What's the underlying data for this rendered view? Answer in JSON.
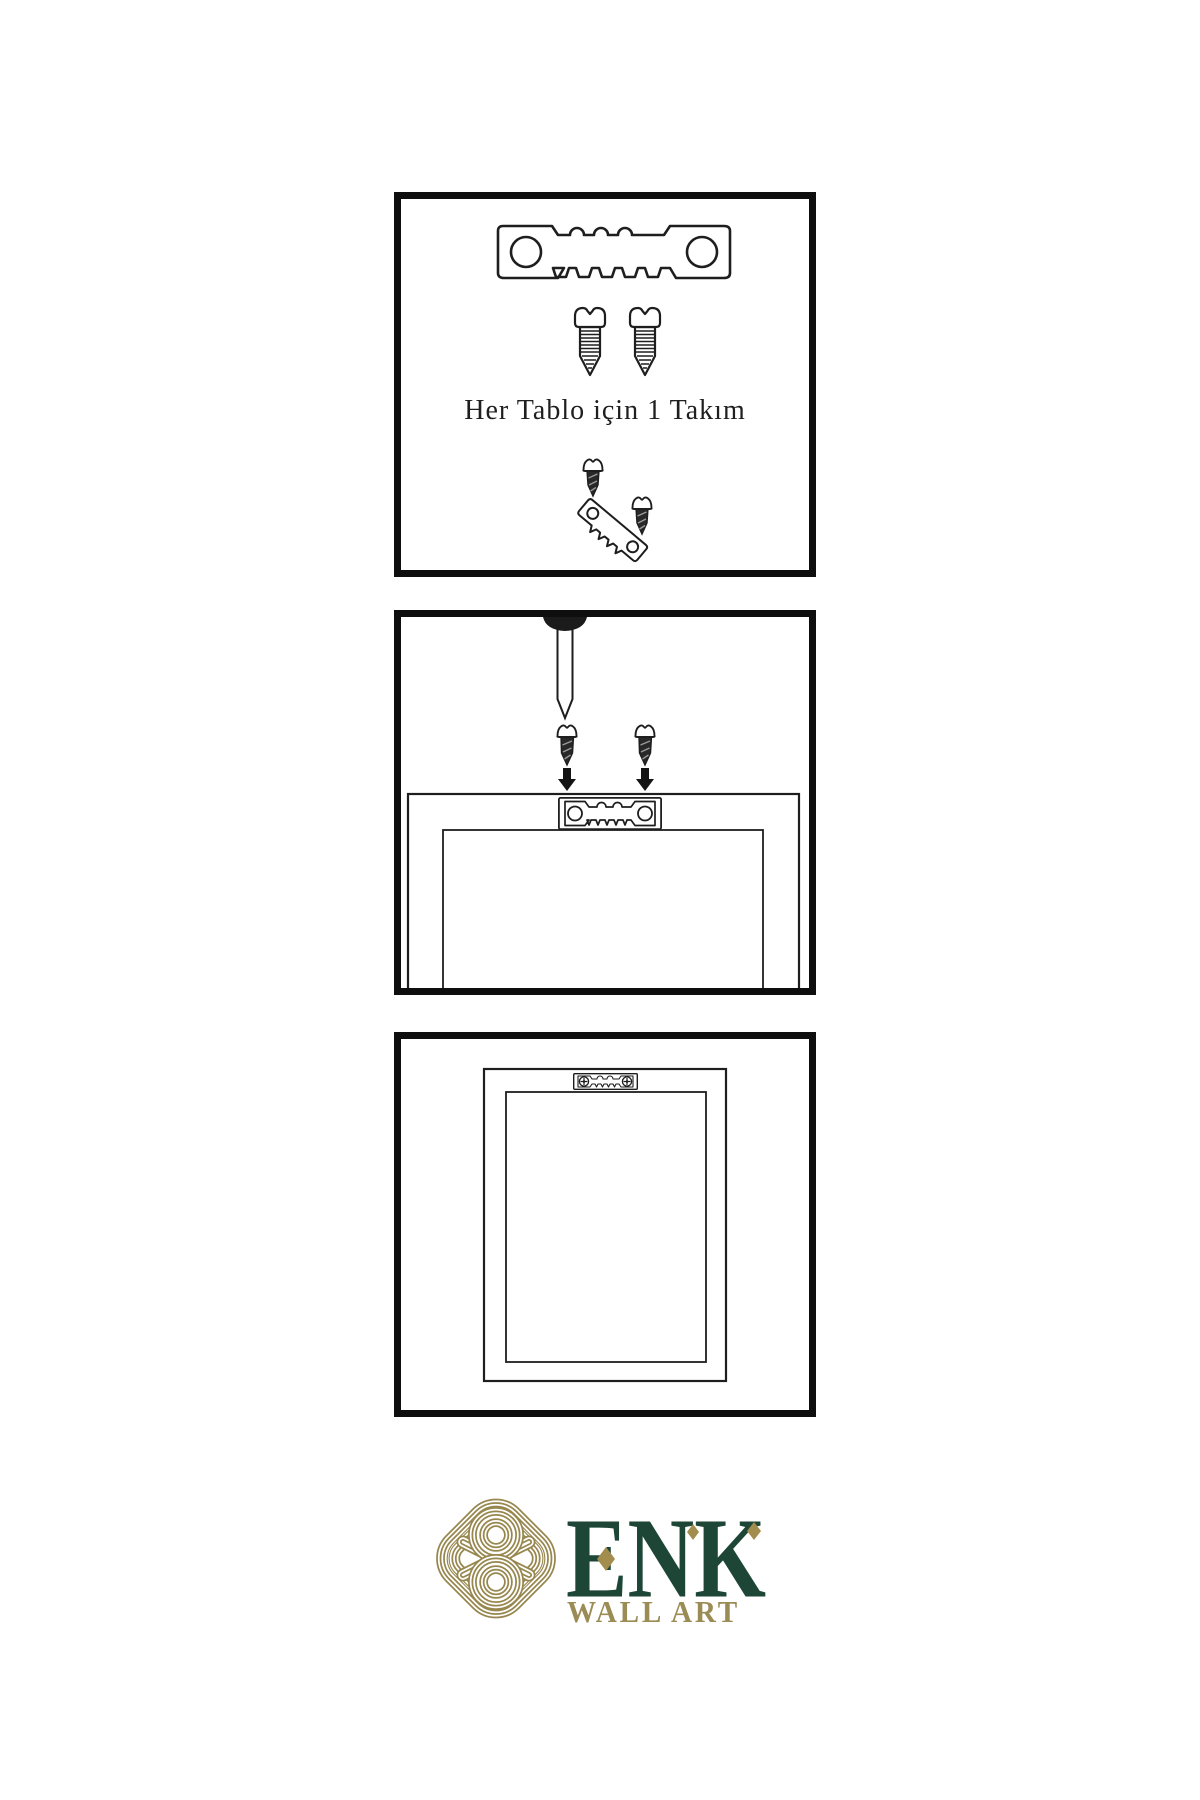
{
  "canvas": {
    "background": "#ffffff"
  },
  "panels": [
    {
      "name": "hardware-set",
      "caption": "Her Tablo için 1 Takım",
      "icons": [
        "sawtooth-hanger-icon",
        "screw-icon",
        "screw-icon",
        "dark-screw-icon",
        "tilted-sawtooth-hanger-icon",
        "dark-screw-icon"
      ]
    },
    {
      "name": "wall-mounting-step",
      "caption": "",
      "icons": [
        "nail-icon",
        "dark-screw-icon",
        "dark-screw-icon",
        "arrow-down-icon",
        "arrow-down-icon",
        "sawtooth-hanger-icon",
        "frame-back-icon"
      ]
    },
    {
      "name": "mounted-frame-step",
      "caption": "",
      "icons": [
        "frame-back-icon",
        "sawtooth-hanger-screwed-icon"
      ]
    }
  ],
  "logo": {
    "brand": "ENK",
    "tagline": "WALL ART",
    "knot_icon": "celtic-knot-icon",
    "colors": {
      "brand_green": "#1d4637",
      "brand_gold": "#97874e",
      "diamond_gold": "#a28d4e",
      "ink": "#1e1e1e"
    }
  }
}
